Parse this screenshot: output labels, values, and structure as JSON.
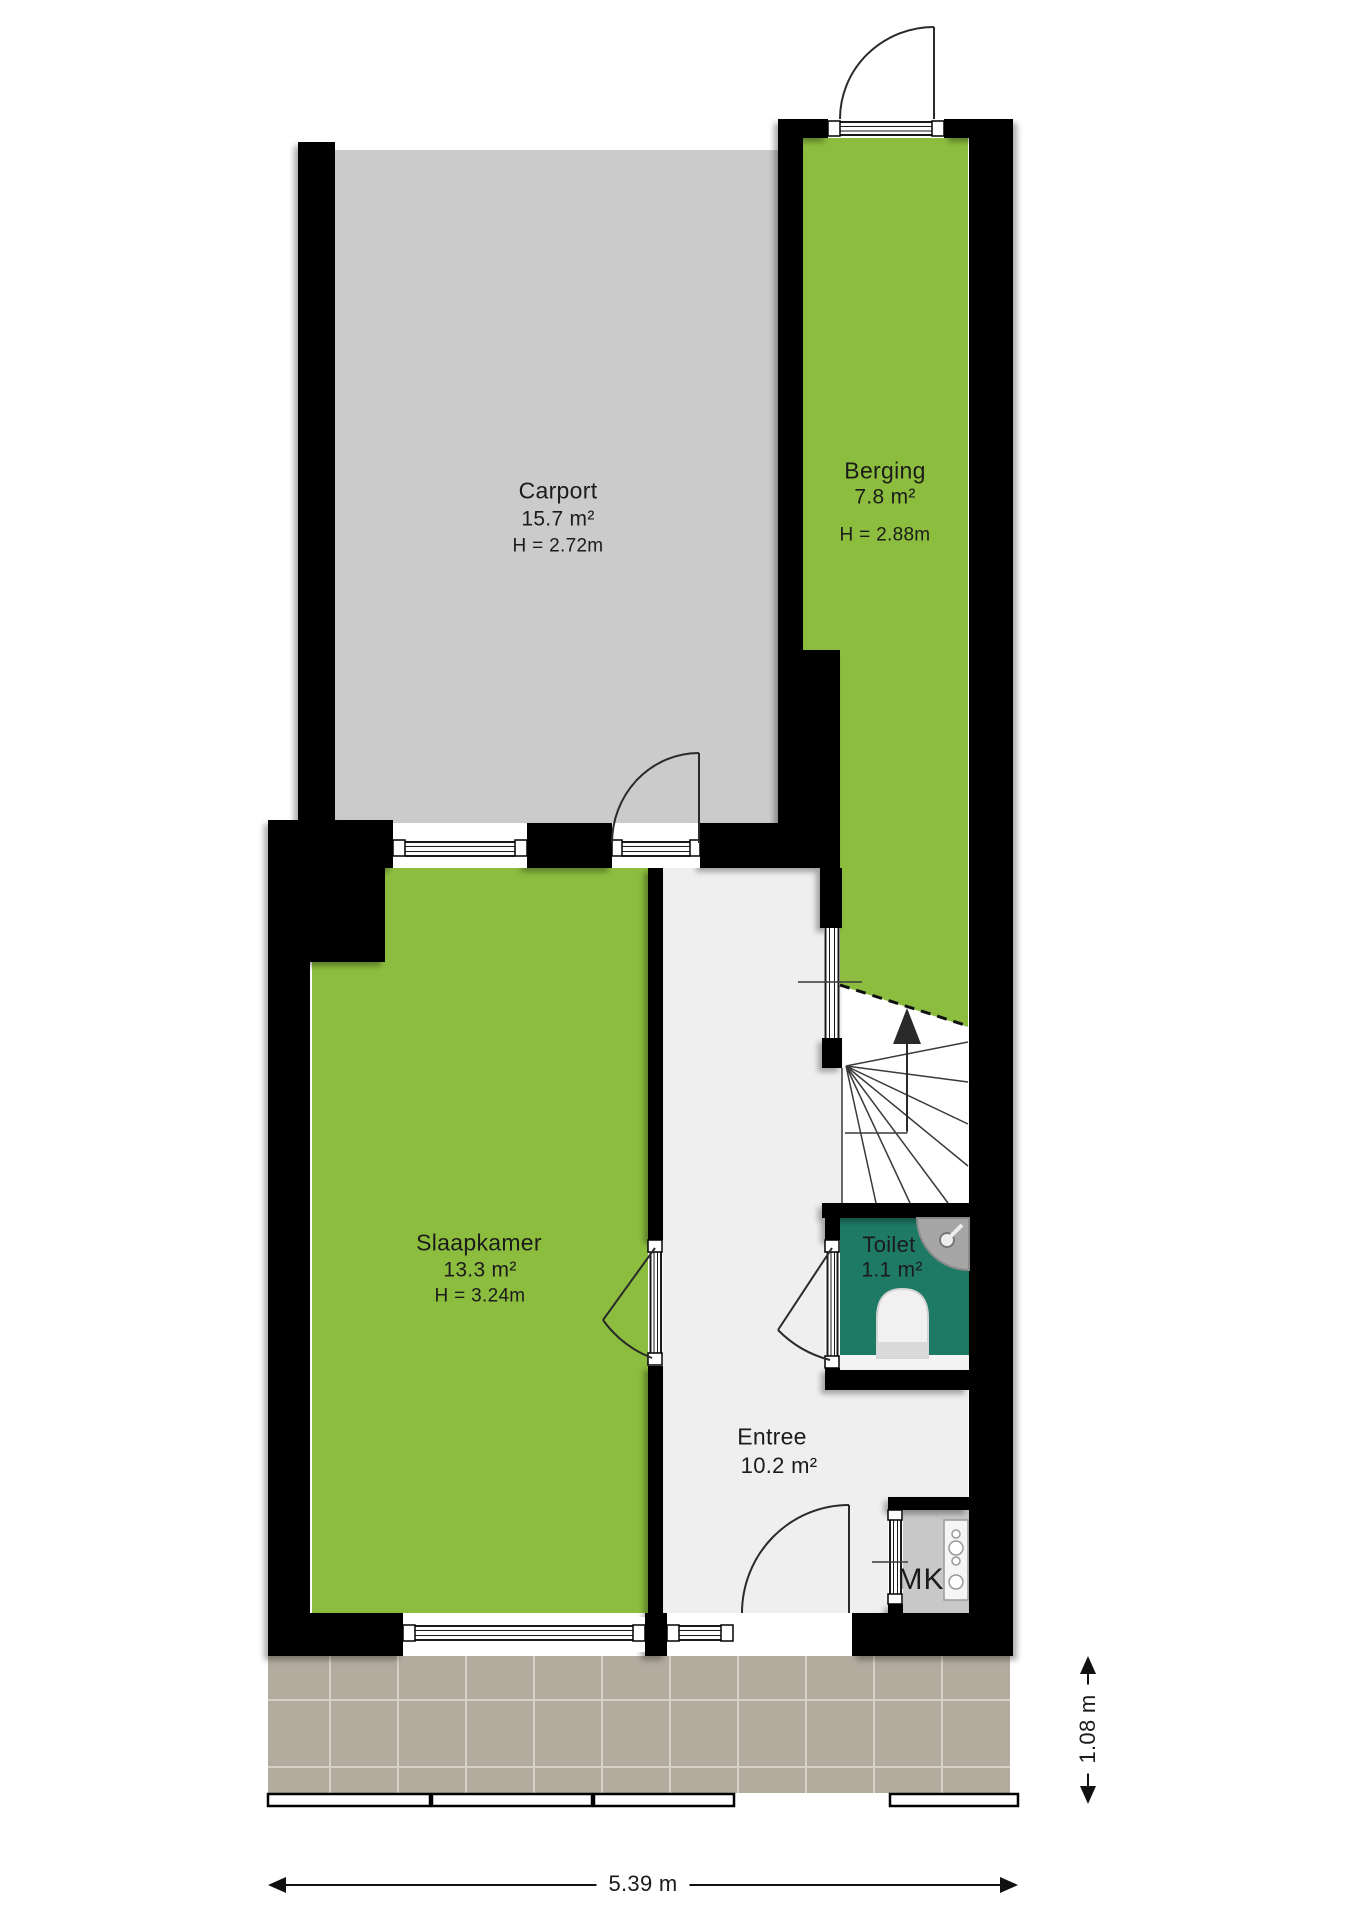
{
  "plan": {
    "rooms": {
      "carport": {
        "name": "Carport",
        "area": "15.7 m²",
        "ceiling": "H = 2.72m"
      },
      "berging": {
        "name": "Berging",
        "area": "7.8 m²",
        "ceiling": "H = 2.88m"
      },
      "slaapkamer": {
        "name": "Slaapkamer",
        "area": "13.3 m²",
        "ceiling": "H = 3.24m"
      },
      "toilet": {
        "name": "Toilet",
        "area": "1.1 m²"
      },
      "entree": {
        "name": "Entree",
        "area": "10.2 m²"
      },
      "meterkast": {
        "label": "MK"
      }
    },
    "dimensions": {
      "bottom_width": "5.39 m",
      "right_depth": "1.08 m"
    },
    "colors": {
      "room_green": "#8cbd3e",
      "toilet_teal": "#1e7a64",
      "carport_gray": "#cbcbcb",
      "entree_gray": "#efefef",
      "mk_gray": "#c8c8c8",
      "tile_taupe": "#b3ab9e",
      "wall_black": "#050505"
    }
  }
}
